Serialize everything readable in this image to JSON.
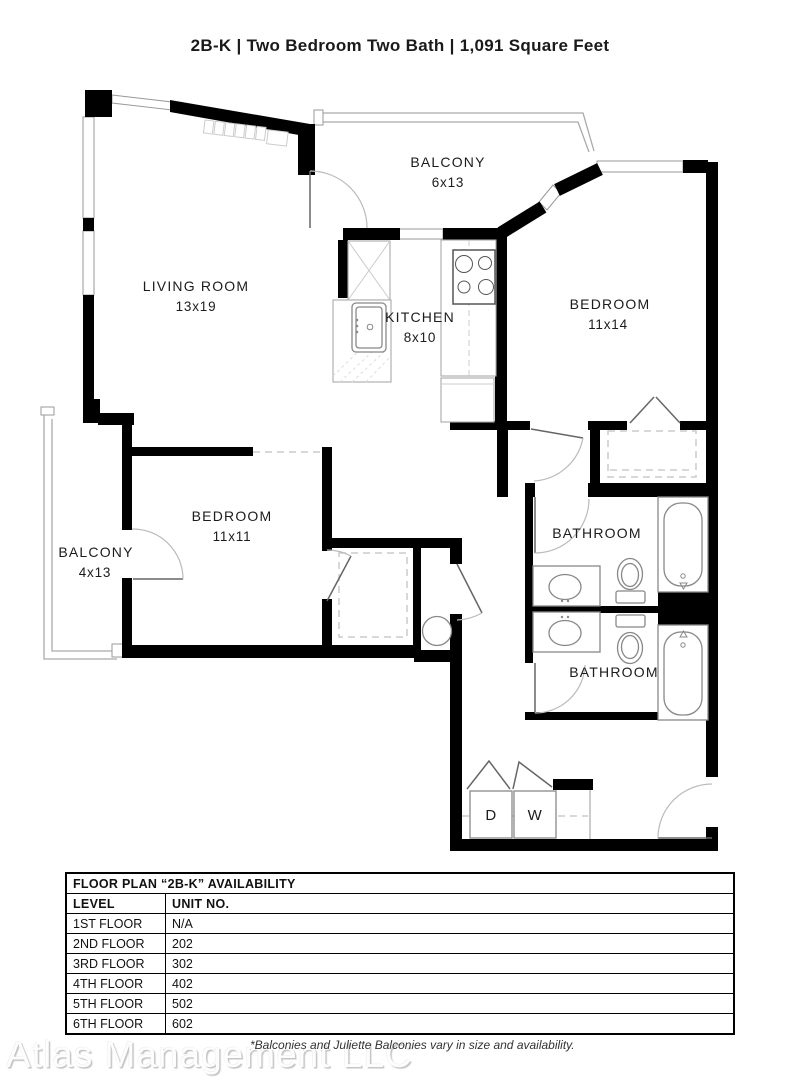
{
  "title": "2B-K | Two Bedroom Two Bath | 1,091 Square Feet",
  "plan": {
    "rooms": {
      "balcony_top": {
        "name": "BALCONY",
        "dims": "6x13"
      },
      "living_room": {
        "name": "LIVING ROOM",
        "dims": "13x19"
      },
      "kitchen": {
        "name": "KITCHEN",
        "dims": "8x10"
      },
      "bedroom_1": {
        "name": "BEDROOM",
        "dims": "11x14"
      },
      "bedroom_2": {
        "name": "BEDROOM",
        "dims": "11x11"
      },
      "balcony_left": {
        "name": "BALCONY",
        "dims": "4x13"
      },
      "bathroom_1": {
        "name": "BATHROOM"
      },
      "bathroom_2": {
        "name": "BATHROOM"
      },
      "dryer": {
        "abbr": "D"
      },
      "washer": {
        "abbr": "W"
      }
    },
    "wall_color": "#000000"
  },
  "availability": {
    "title": "FLOOR PLAN “2B-K” AVAILABILITY",
    "columns": {
      "level": "LEVEL",
      "unit": "UNIT NO."
    },
    "rows": [
      {
        "level": "1ST FLOOR",
        "unit": "N/A"
      },
      {
        "level": "2ND FLOOR",
        "unit": "202"
      },
      {
        "level": "3RD FLOOR",
        "unit": "302"
      },
      {
        "level": "4TH FLOOR",
        "unit": "402"
      },
      {
        "level": "5TH FLOOR",
        "unit": "502"
      },
      {
        "level": "6TH FLOOR",
        "unit": "602"
      }
    ]
  },
  "footer": {
    "watermark": "Atlas Management LLC",
    "note": "*Balconies and Juliette Balconies vary in size and availability."
  }
}
